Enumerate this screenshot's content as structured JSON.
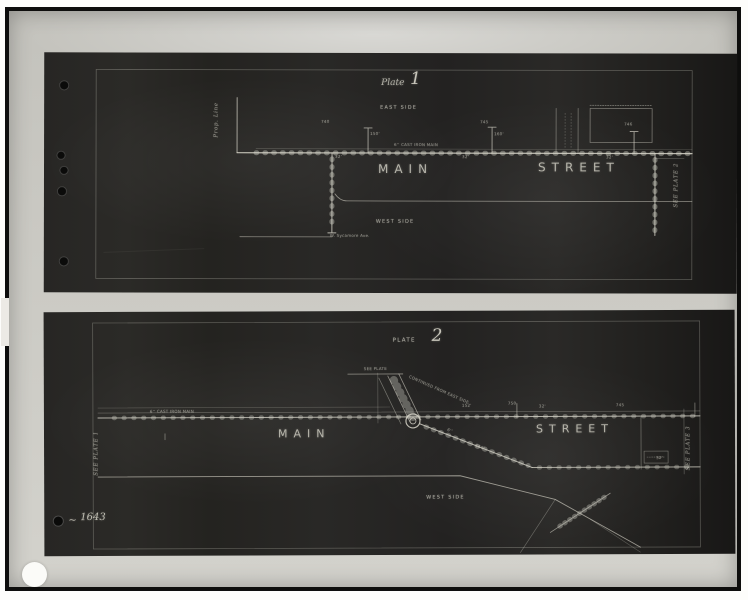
{
  "photo": {
    "archive_mark": "~",
    "archive_number": "1643"
  },
  "plate1": {
    "title_word": "Plate",
    "title_number": "1",
    "east_side": "EAST SIDE",
    "west_side": "WEST SIDE",
    "street_name_left": "MAIN",
    "street_name_right": "STREET",
    "prop_line": "Prop. Line",
    "see_plate": "SEE PLATE 2",
    "cross_street": "W. Sycamore Ave.",
    "pipe_label": "6'' CAST IRON MAIN",
    "measurements": [
      "740",
      "150'",
      "32'",
      "745",
      "160'",
      "32'",
      "746",
      "32'"
    ]
  },
  "plate2": {
    "title_word": "PLATE",
    "title_number": "2",
    "see_plate_note": "SEE PLATE",
    "continued_note": "CONTINUED FROM EAST SIDE",
    "west_side": "WEST SIDE",
    "street_name_left": "MAIN",
    "street_name_right": "STREET",
    "see_plate_left": "SEE PLATE 1",
    "see_plate_right": "SEE PLATE 3",
    "pipe_label": "6'' CAST IRON MAIN",
    "measurements": [
      "750",
      "152'",
      "32'",
      "745",
      "6''",
      "150'",
      "32'"
    ]
  },
  "colors": {
    "mount": "#c8c7c1",
    "sheet": "#262522",
    "line": "#d8d6ca"
  }
}
